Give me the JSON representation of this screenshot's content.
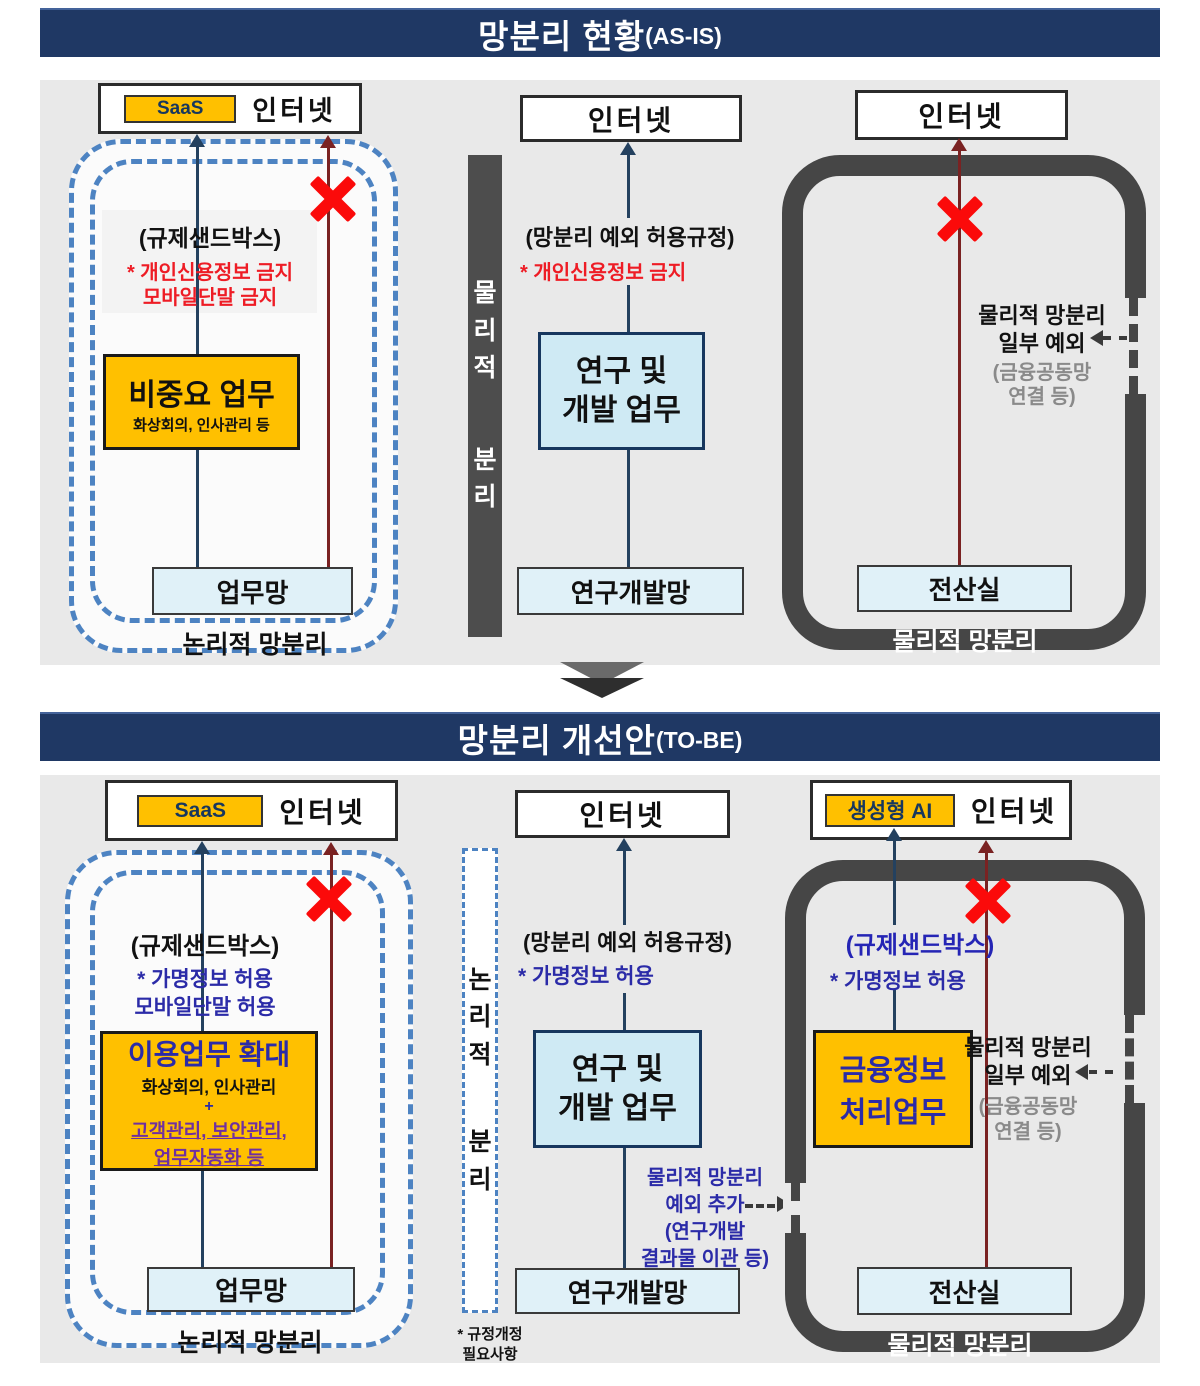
{
  "colors": {
    "banner_bg": "#1f3864",
    "panel_bg": "#e9e9e9",
    "orange": "#ffc000",
    "light_blue": "#e0f1f8",
    "rnd_blue": "#cfeaf4",
    "dash_blue": "#4d83c2",
    "dark_gray": "#464646",
    "navy_line": "#24415f",
    "maroon_line": "#7a2222",
    "red_text": "#ee1c25",
    "indigo_text": "#2b2ba8",
    "purple_text": "#7030a0",
    "blue_text": "#2525b5",
    "x_red": "#fb0a0a"
  },
  "as_is": {
    "banner": {
      "title": "망분리 현황",
      "suffix": "(AS-IS)"
    },
    "left": {
      "saas": "SaaS",
      "internet": "인터넷",
      "sandbox": "(규제샌드박스)",
      "note1": "* 개인신용정보 금지",
      "note2": "모바일단말 금지",
      "work_title": "비중요 업무",
      "work_sub": "화상회의, 인사관리 등",
      "network": "업무망",
      "zone": "논리적 망분리"
    },
    "divider": {
      "part1": "물리적",
      "part2": "분리"
    },
    "middle": {
      "internet": "인터넷",
      "rule": "(망분리 예외 허용규정)",
      "note": "* 개인신용정보 금지",
      "work1": "연구 및",
      "work2": "개발 업무",
      "network": "연구개발망"
    },
    "right": {
      "internet": "인터넷",
      "exc1": "물리적 망분리",
      "exc2": "일부 예외",
      "exc3": "(금융공동망",
      "exc4": "연결 등)",
      "room": "전산실",
      "zone": "물리적 망분리"
    }
  },
  "to_be": {
    "banner": {
      "title": "망분리 개선안",
      "suffix": "(TO-BE)"
    },
    "left": {
      "saas": "SaaS",
      "internet": "인터넷",
      "sandbox": "(규제샌드박스)",
      "note1": "* 가명정보 허용",
      "note2": "모바일단말 허용",
      "work_title": "이용업무 확대",
      "work_sub": "화상회의, 인사관리",
      "plus": "+",
      "add1": "고객관리, 보안관리,",
      "add2": "업무자동화 등",
      "network": "업무망",
      "zone": "논리적 망분리"
    },
    "divider": {
      "part1": "논리적",
      "part2": "분리",
      "foot1": "* 규정개정",
      "foot2": "필요사항"
    },
    "middle": {
      "internet": "인터넷",
      "rule": "(망분리 예외 허용규정)",
      "note": "* 가명정보 허용",
      "work1": "연구 및",
      "work2": "개발 업무",
      "network": "연구개발망",
      "exception": [
        "물리적 망분리",
        "예외 추가",
        "(연구개발",
        "결과물 이관 등)"
      ]
    },
    "right": {
      "genai": "생성형 AI",
      "internet": "인터넷",
      "sandbox": "(규제샌드박스)",
      "note": "* 가명정보 허용",
      "work1": "금융정보",
      "work2": "처리업무",
      "exc1": "물리적 망분리",
      "exc2": "일부 예외",
      "exc3": "(금융공동망",
      "exc4": "연결 등)",
      "room": "전산실",
      "zone": "물리적 망분리"
    }
  }
}
